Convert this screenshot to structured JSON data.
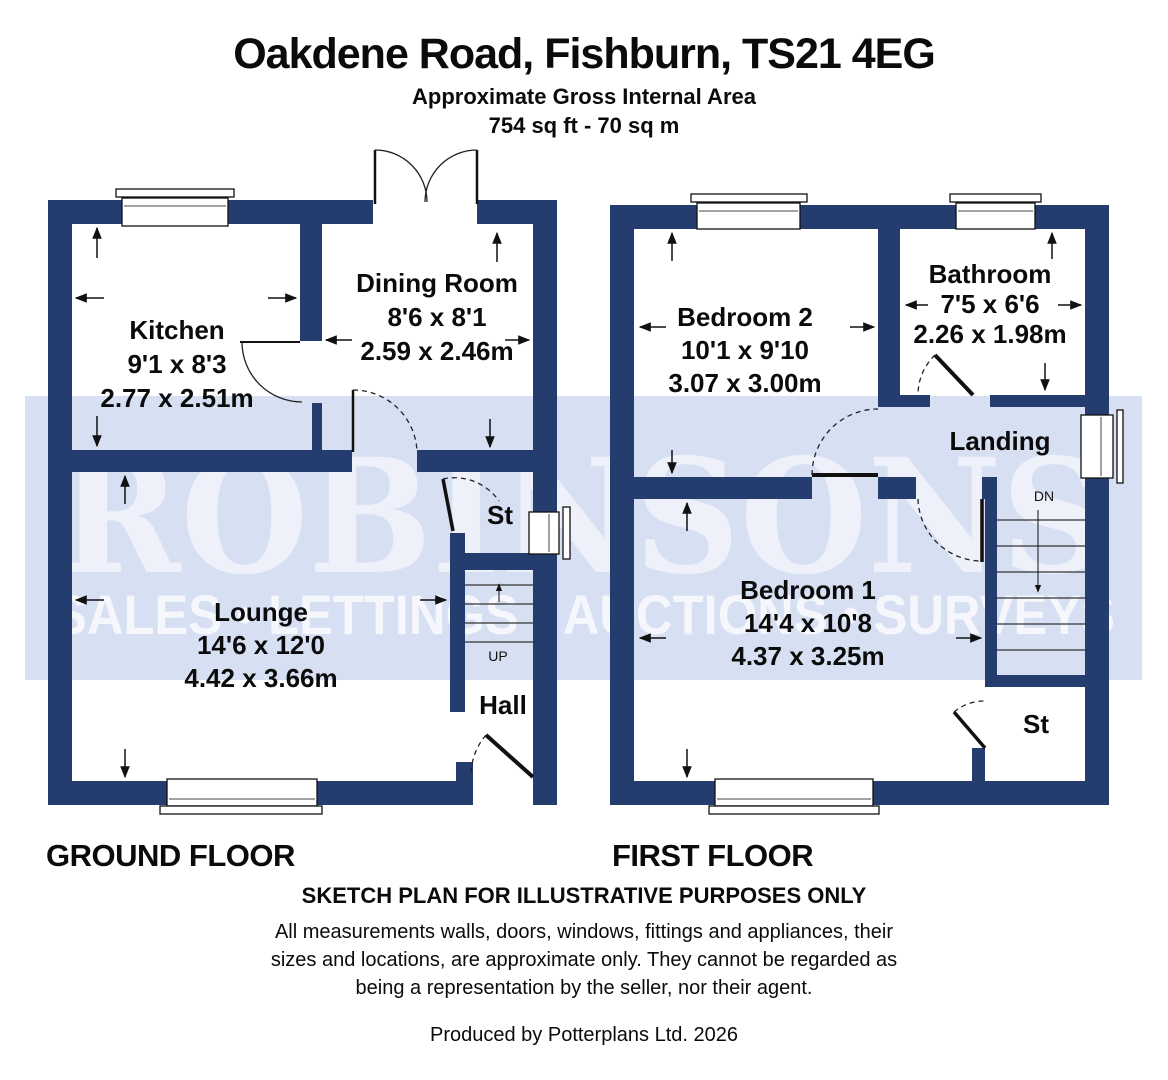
{
  "header": {
    "title": "Oakdene Road, Fishburn, TS21 4EG",
    "subtitle": "Approximate Gross Internal Area",
    "area": "754 sq ft - 70 sq m"
  },
  "watermark": {
    "brand": "ROBINSONS",
    "tagline": "SALES • LETTINGS • AUCTIONS • SURVEYS"
  },
  "colors": {
    "wall": "#253c6e",
    "band": "#d7dff3",
    "brand_text": "#eef1fa",
    "tagline_text": "#f5f7fd"
  },
  "ground_floor": {
    "label": "GROUND FLOOR",
    "rooms": {
      "kitchen": {
        "name": "Kitchen",
        "imperial": "9'1 x 8'3",
        "metric": "2.77 x 2.51m"
      },
      "dining_room": {
        "name": "Dining Room",
        "imperial": "8'6 x 8'1",
        "metric": "2.59 x 2.46m"
      },
      "lounge": {
        "name": "Lounge",
        "imperial": "14'6 x 12'0",
        "metric": "4.42 x 3.66m"
      },
      "store": {
        "name": "St"
      },
      "hall": {
        "name": "Hall"
      },
      "stairs_label": "UP"
    }
  },
  "first_floor": {
    "label": "FIRST FLOOR",
    "rooms": {
      "bedroom2": {
        "name": "Bedroom 2",
        "imperial": "10'1 x 9'10",
        "metric": "3.07 x 3.00m"
      },
      "bathroom": {
        "name": "Bathroom",
        "imperial": "7'5 x 6'6",
        "metric": "2.26 x 1.98m"
      },
      "bedroom1": {
        "name": "Bedroom 1",
        "imperial": "14'4 x 10'8",
        "metric": "4.37 x 3.25m"
      },
      "landing": {
        "name": "Landing"
      },
      "store": {
        "name": "St"
      },
      "stairs_label": "DN"
    }
  },
  "footer": {
    "sketch_note": "SKETCH PLAN FOR ILLUSTRATIVE PURPOSES ONLY",
    "disclaimer_lines": [
      "All measurements walls, doors, windows, fittings and appliances, their",
      "sizes and locations, are approximate only. They cannot be regarded as",
      "being a representation by the seller, nor their agent."
    ],
    "produced_by": "Produced by Potterplans Ltd. 2026"
  }
}
